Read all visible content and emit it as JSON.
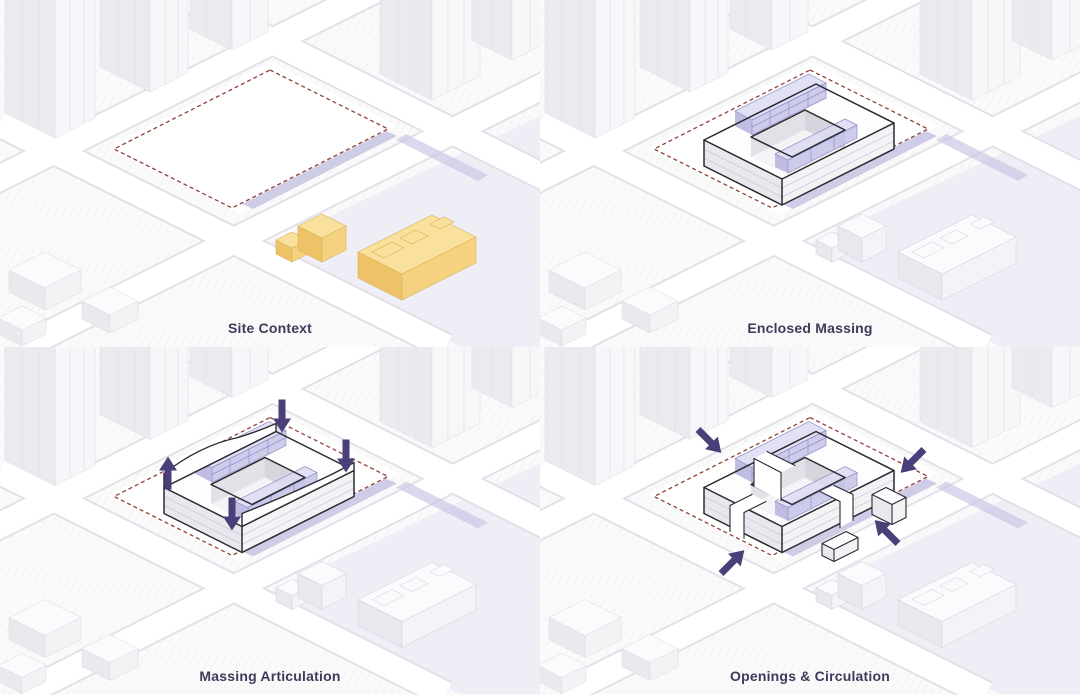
{
  "figure": {
    "type": "architectural-massing-diagram-series",
    "view": "axonometric site diagrams, 2x2 grid"
  },
  "colors": {
    "accent_purple": "#4a3f78",
    "boundary_dash_red": "#8f4138",
    "lavender_strip": "#c9c7e4",
    "glazing_lavender": "#c6c3e8",
    "context_yellow_top": "#f9e09c",
    "context_yellow_left": "#eec368",
    "context_yellow_right": "#f4d27f",
    "label_text": "#3e3b5a"
  },
  "panels": [
    {
      "id": "site-context",
      "label": "Site Context",
      "elements": [
        "dashed-site-boundary",
        "lavender-frontage-strip",
        "existing-buildings-highlighted-yellow",
        "context-towers",
        "street-grid"
      ]
    },
    {
      "id": "enclosed-massing",
      "label": "Enclosed Massing",
      "elements": [
        "dashed-site-boundary",
        "courtyard-ring-massing",
        "glazed-lavender-volumes",
        "lavender-frontage-strip"
      ]
    },
    {
      "id": "massing-articulation",
      "label": "Massing Articulation",
      "arrows": [
        "up",
        "down",
        "down",
        "down"
      ],
      "elements": [
        "sculpted-courtyard-massing",
        "push-pull-arrows",
        "glazed-lavender-volumes"
      ]
    },
    {
      "id": "openings-circulation",
      "label": "Openings & Circulation",
      "arrows": [
        "inward-from-nw",
        "inward-from-ne",
        "inward-from-se",
        "inward-from-sw"
      ],
      "elements": [
        "fragmented-massing-with-openings",
        "circulation-arrows",
        "glazed-lavender-volumes"
      ]
    }
  ]
}
